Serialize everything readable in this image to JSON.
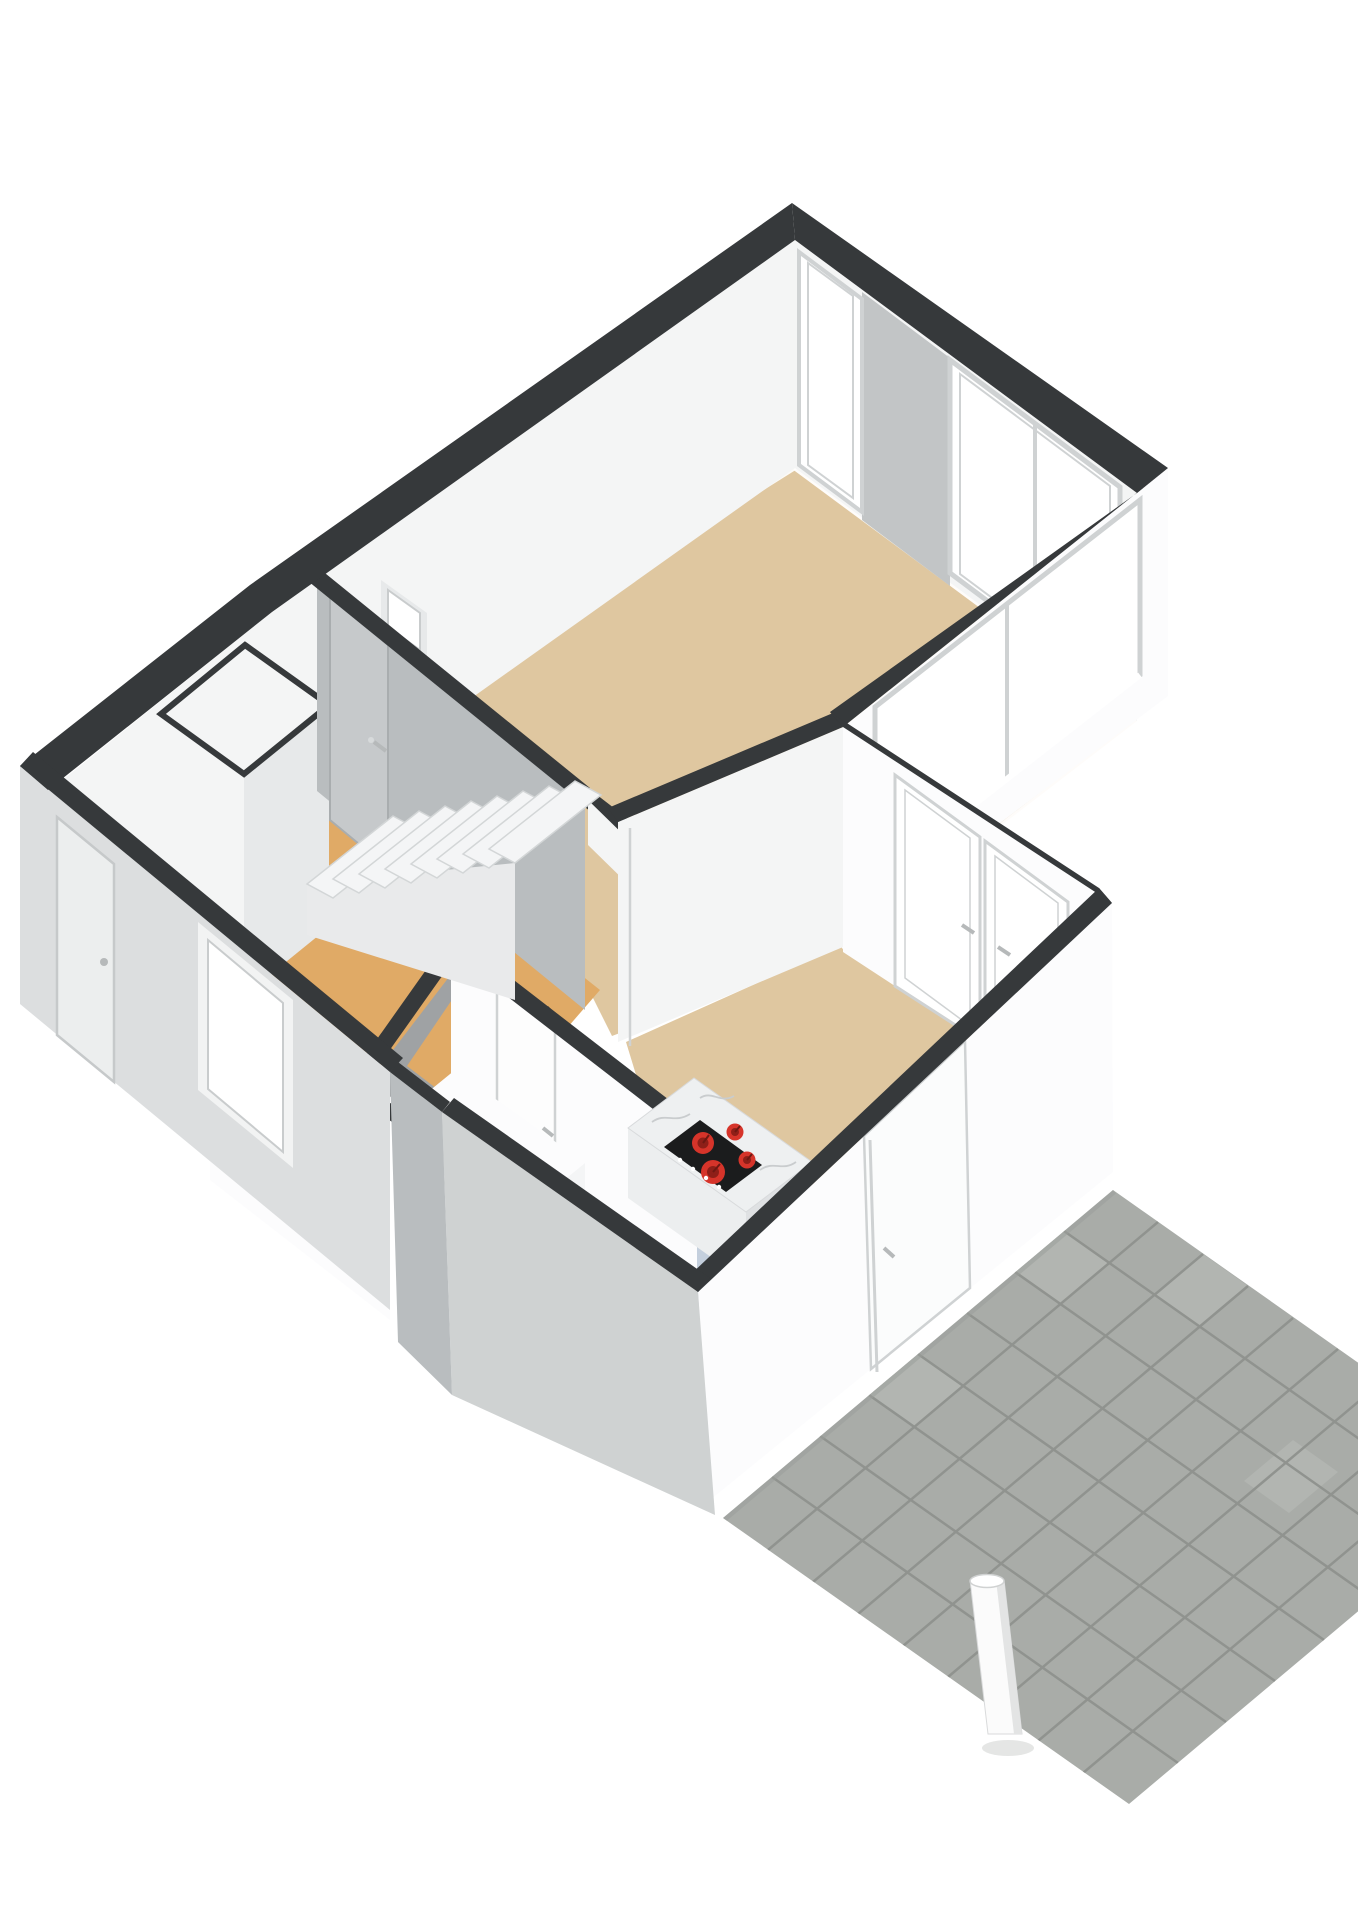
{
  "meta": {
    "type": "3d-floor-plan-rendering",
    "view": "isometric-birds-eye",
    "description": "Open-top 3D floor plan of a ground floor with living room, hallway with staircase, kitchen with cooking island, and an outdoor tiled terrace with a pole"
  },
  "colors": {
    "bg": "#ffffff",
    "capDark": "#36393b",
    "wallWhite": "#f4f5f5",
    "wallBright": "#fcfcfd",
    "wallShaded": "#c2c5c6",
    "wallGrayFace": "#b9bdbf",
    "extGrayLight": "#dcdedf",
    "extGray": "#cfd2d2",
    "doorFace": "#eceeee",
    "floorLiving": "#dfc7a0",
    "floorHall": "#e0aa66",
    "floorKitchen": "#c4cfdd",
    "patioTile": "#a9aca8",
    "patioTileLight": "#b2b5b1",
    "patioGrout": "#90938f",
    "patioShadow": "#9b9e9a",
    "marbleTop": "#eef0f1",
    "marbleVein": "#c9ccce",
    "islandSide": "#dfe1e3",
    "islandSideLight": "#eceeef",
    "cooktop": "#1b1c1d",
    "burner": "#d6342a",
    "burnerDark": "#8e1f18",
    "frame": "#cfd2d3",
    "frameLight": "#e7e9ea",
    "glass": "#ffffff",
    "handle": "#b6b9ba",
    "sillWhite": "#ffffff",
    "shadowInterior": "#9fa2a4",
    "stairTread": "#f4f5f6",
    "stairSide": "#e9eaeb",
    "treadEdge": "#d3d6d7",
    "poleWhite": "#fbfbfb",
    "poleShade": "#e3e4e4"
  },
  "scene": {
    "rooms": [
      {
        "name": "living-room",
        "floor": "beige"
      },
      {
        "name": "hallway-with-staircase",
        "floor": "orange-tan"
      },
      {
        "name": "kitchen",
        "floor": "light-blue"
      },
      {
        "name": "kitchen-dining-area",
        "floor": "beige"
      },
      {
        "name": "toilet",
        "floor": "orange-tan"
      }
    ],
    "features": {
      "staircase_treads": 8,
      "kitchen_island": {
        "countertop": "white-marble",
        "cooktop_burners": 4,
        "control_knobs": 4
      },
      "terrace": {
        "material": "gray-concrete-tiles",
        "pattern": "grid"
      },
      "pole_count": 1,
      "doors": {
        "front_door": 1,
        "back_door": 1,
        "french_double_door": 1,
        "interior_doors": 4
      },
      "windows": {
        "northeast_wall": 2,
        "east_wall_large": 1,
        "front_wall": 1,
        "small_hallway_window": 1
      }
    },
    "wall_top_color": "anthracite",
    "background": "white"
  }
}
